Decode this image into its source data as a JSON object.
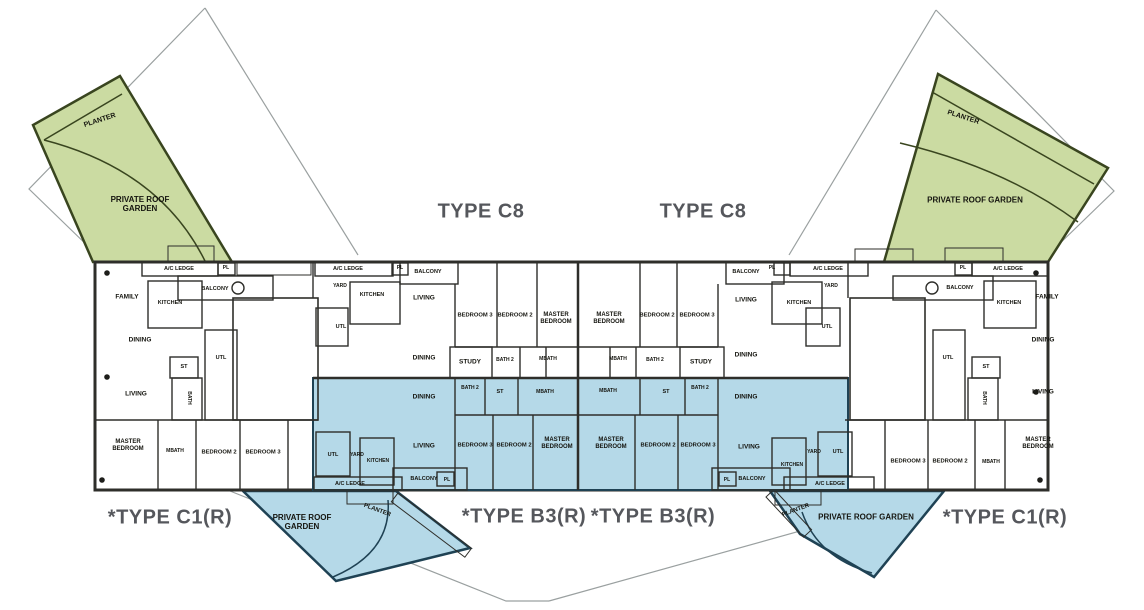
{
  "plan": {
    "title": "Apartment floor plan with unit types C8, B3(R), C1(R)",
    "colors": {
      "green": "#cbdba2",
      "blue": "#b5d9e8",
      "wall_dark": "#2e2e2a",
      "green_outline": "#39451f",
      "blue_outline": "#1f4254",
      "boundary_line": "#9aa0a0",
      "type_label_text": "#55575c",
      "room_label_text": "#15150f",
      "background": "#ffffff"
    },
    "unit_types": [
      "TYPE C8",
      "*TYPE B3(R)",
      "*TYPE C1(R)"
    ],
    "type_labels": [
      {
        "t": "TYPE C8",
        "x": 481,
        "y": 212
      },
      {
        "t": "TYPE C8",
        "x": 703,
        "y": 212
      },
      {
        "t": "*TYPE C1(R)",
        "x": 170,
        "y": 518
      },
      {
        "t": "*TYPE B3(R)",
        "x": 524,
        "y": 517
      },
      {
        "t": "*TYPE B3(R)",
        "x": 653,
        "y": 517
      },
      {
        "t": "*TYPE C1(R)",
        "x": 1005,
        "y": 518
      }
    ],
    "room_labels": [
      {
        "t": "PLANTER",
        "x": 100,
        "y": 121,
        "r": -18,
        "s": 7
      },
      {
        "t": "PRIVATE ROOF\nGARDEN",
        "x": 140,
        "y": 204,
        "s": 8
      },
      {
        "t": "PLANTER",
        "x": 963,
        "y": 118,
        "r": 18,
        "s": 7
      },
      {
        "t": "PRIVATE ROOF GARDEN",
        "x": 975,
        "y": 200,
        "s": 8
      },
      {
        "t": "A/C LEDGE",
        "x": 179,
        "y": 269,
        "s": 5.5
      },
      {
        "t": "PL",
        "x": 226,
        "y": 269,
        "s": 5
      },
      {
        "t": "FAMILY",
        "x": 127,
        "y": 297
      },
      {
        "t": "KITCHEN",
        "x": 170,
        "y": 303,
        "s": 5.5
      },
      {
        "t": "BALCONY",
        "x": 215,
        "y": 289,
        "s": 5.5
      },
      {
        "t": "DINING",
        "x": 140,
        "y": 340
      },
      {
        "t": "UTL",
        "x": 221,
        "y": 358,
        "s": 5.5
      },
      {
        "t": "ST",
        "x": 184,
        "y": 367,
        "s": 5.5
      },
      {
        "t": "LIVING",
        "x": 136,
        "y": 394
      },
      {
        "t": "BATH",
        "x": 188,
        "y": 398,
        "r": 90,
        "s": 5
      },
      {
        "t": "MASTER\nBEDROOM",
        "x": 128,
        "y": 446,
        "s": 6
      },
      {
        "t": "MBATH",
        "x": 175,
        "y": 452,
        "s": 5
      },
      {
        "t": "BEDROOM 2",
        "x": 219,
        "y": 453,
        "s": 5.8
      },
      {
        "t": "BEDROOM 3",
        "x": 263,
        "y": 453,
        "s": 5.8
      },
      {
        "t": "A/C LEDGE",
        "x": 348,
        "y": 269,
        "s": 5.5
      },
      {
        "t": "YARD",
        "x": 340,
        "y": 287,
        "s": 5
      },
      {
        "t": "KITCHEN",
        "x": 372,
        "y": 295,
        "s": 5.5
      },
      {
        "t": "PL",
        "x": 400,
        "y": 269,
        "s": 5
      },
      {
        "t": "BALCONY",
        "x": 428,
        "y": 272,
        "s": 5.5
      },
      {
        "t": "LIVING",
        "x": 424,
        "y": 298
      },
      {
        "t": "UTL",
        "x": 341,
        "y": 327,
        "s": 5.5
      },
      {
        "t": "BEDROOM 3",
        "x": 475,
        "y": 316,
        "s": 5.8
      },
      {
        "t": "BEDROOM 2",
        "x": 515,
        "y": 316,
        "s": 5.8
      },
      {
        "t": "MASTER\nBEDROOM",
        "x": 556,
        "y": 319,
        "s": 6
      },
      {
        "t": "DINING",
        "x": 424,
        "y": 358
      },
      {
        "t": "STUDY",
        "x": 470,
        "y": 362
      },
      {
        "t": "BATH 2",
        "x": 505,
        "y": 361,
        "s": 5
      },
      {
        "t": "MBATH",
        "x": 548,
        "y": 360,
        "s": 5
      },
      {
        "t": "MASTER\nBEDROOM",
        "x": 609,
        "y": 319,
        "s": 6
      },
      {
        "t": "BEDROOM 2",
        "x": 657,
        "y": 316,
        "s": 5.8
      },
      {
        "t": "BEDROOM 3",
        "x": 697,
        "y": 316,
        "s": 5.8
      },
      {
        "t": "BALCONY",
        "x": 746,
        "y": 272,
        "s": 5.5
      },
      {
        "t": "PL",
        "x": 772,
        "y": 269,
        "s": 5
      },
      {
        "t": "A/C LEDGE",
        "x": 828,
        "y": 269,
        "s": 5.5
      },
      {
        "t": "YARD",
        "x": 831,
        "y": 287,
        "s": 5
      },
      {
        "t": "KITCHEN",
        "x": 799,
        "y": 303,
        "s": 5.5
      },
      {
        "t": "LIVING",
        "x": 746,
        "y": 300
      },
      {
        "t": "UTL",
        "x": 827,
        "y": 327,
        "s": 5.5
      },
      {
        "t": "DINING",
        "x": 746,
        "y": 355
      },
      {
        "t": "STUDY",
        "x": 701,
        "y": 362
      },
      {
        "t": "MBATH",
        "x": 618,
        "y": 360,
        "s": 5
      },
      {
        "t": "BATH 2",
        "x": 655,
        "y": 361,
        "s": 5
      },
      {
        "t": "DINING",
        "x": 424,
        "y": 397
      },
      {
        "t": "BATH 2",
        "x": 470,
        "y": 389,
        "s": 5
      },
      {
        "t": "ST",
        "x": 500,
        "y": 392,
        "s": 5.5
      },
      {
        "t": "MBATH",
        "x": 545,
        "y": 393,
        "s": 5
      },
      {
        "t": "LIVING",
        "x": 424,
        "y": 446
      },
      {
        "t": "BEDROOM 3",
        "x": 475,
        "y": 446,
        "s": 5.8
      },
      {
        "t": "BEDROOM 2",
        "x": 514,
        "y": 446,
        "s": 5.8
      },
      {
        "t": "MASTER\nBEDROOM",
        "x": 557,
        "y": 444,
        "s": 6
      },
      {
        "t": "BALCONY",
        "x": 424,
        "y": 479,
        "s": 5.5
      },
      {
        "t": "PL",
        "x": 447,
        "y": 481,
        "s": 5
      },
      {
        "t": "UTL",
        "x": 333,
        "y": 455,
        "s": 5.5
      },
      {
        "t": "YARD",
        "x": 357,
        "y": 456,
        "s": 5
      },
      {
        "t": "KITCHEN",
        "x": 378,
        "y": 462,
        "s": 5
      },
      {
        "t": "A/C LEDGE",
        "x": 350,
        "y": 484,
        "s": 5.5
      },
      {
        "t": "PLANTER",
        "x": 377,
        "y": 511,
        "r": 20,
        "s": 6
      },
      {
        "t": "PRIVATE ROOF\nGARDEN",
        "x": 302,
        "y": 522,
        "s": 8
      },
      {
        "t": "MBATH",
        "x": 608,
        "y": 392,
        "s": 5
      },
      {
        "t": "ST",
        "x": 666,
        "y": 392,
        "s": 5.5
      },
      {
        "t": "BATH 2",
        "x": 700,
        "y": 389,
        "s": 5
      },
      {
        "t": "DINING",
        "x": 746,
        "y": 397
      },
      {
        "t": "MASTER\nBEDROOM",
        "x": 611,
        "y": 444,
        "s": 6
      },
      {
        "t": "BEDROOM 2",
        "x": 658,
        "y": 446,
        "s": 5.8
      },
      {
        "t": "BEDROOM 3",
        "x": 698,
        "y": 446,
        "s": 5.8
      },
      {
        "t": "LIVING",
        "x": 749,
        "y": 447
      },
      {
        "t": "BALCONY",
        "x": 752,
        "y": 479,
        "s": 5.5
      },
      {
        "t": "PL",
        "x": 727,
        "y": 481,
        "s": 5
      },
      {
        "t": "KITCHEN",
        "x": 792,
        "y": 466,
        "s": 5
      },
      {
        "t": "YARD",
        "x": 814,
        "y": 453,
        "s": 5
      },
      {
        "t": "UTL",
        "x": 838,
        "y": 452,
        "s": 5.5
      },
      {
        "t": "A/C LEDGE",
        "x": 830,
        "y": 484,
        "s": 5.5
      },
      {
        "t": "PLANTER",
        "x": 796,
        "y": 511,
        "r": -20,
        "s": 6
      },
      {
        "t": "PRIVATE ROOF GARDEN",
        "x": 866,
        "y": 517,
        "s": 8
      },
      {
        "t": "PL",
        "x": 963,
        "y": 269,
        "s": 5
      },
      {
        "t": "A/C LEDGE",
        "x": 1008,
        "y": 269,
        "s": 5.5
      },
      {
        "t": "BALCONY",
        "x": 960,
        "y": 288,
        "s": 5.5
      },
      {
        "t": "KITCHEN",
        "x": 1009,
        "y": 303,
        "s": 5.5
      },
      {
        "t": "FAMILY",
        "x": 1047,
        "y": 297
      },
      {
        "t": "DINING",
        "x": 1043,
        "y": 340
      },
      {
        "t": "UTL",
        "x": 948,
        "y": 358,
        "s": 5.5
      },
      {
        "t": "ST",
        "x": 986,
        "y": 367,
        "s": 5.5
      },
      {
        "t": "LIVING",
        "x": 1043,
        "y": 392
      },
      {
        "t": "BATH",
        "x": 983,
        "y": 398,
        "r": 90,
        "s": 5
      },
      {
        "t": "MASTER\nBEDROOM",
        "x": 1038,
        "y": 444,
        "s": 6
      },
      {
        "t": "MBATH",
        "x": 991,
        "y": 463,
        "s": 5
      },
      {
        "t": "BEDROOM 2",
        "x": 950,
        "y": 462,
        "s": 5.8
      },
      {
        "t": "BEDROOM 3",
        "x": 908,
        "y": 462,
        "s": 5.8
      }
    ]
  }
}
